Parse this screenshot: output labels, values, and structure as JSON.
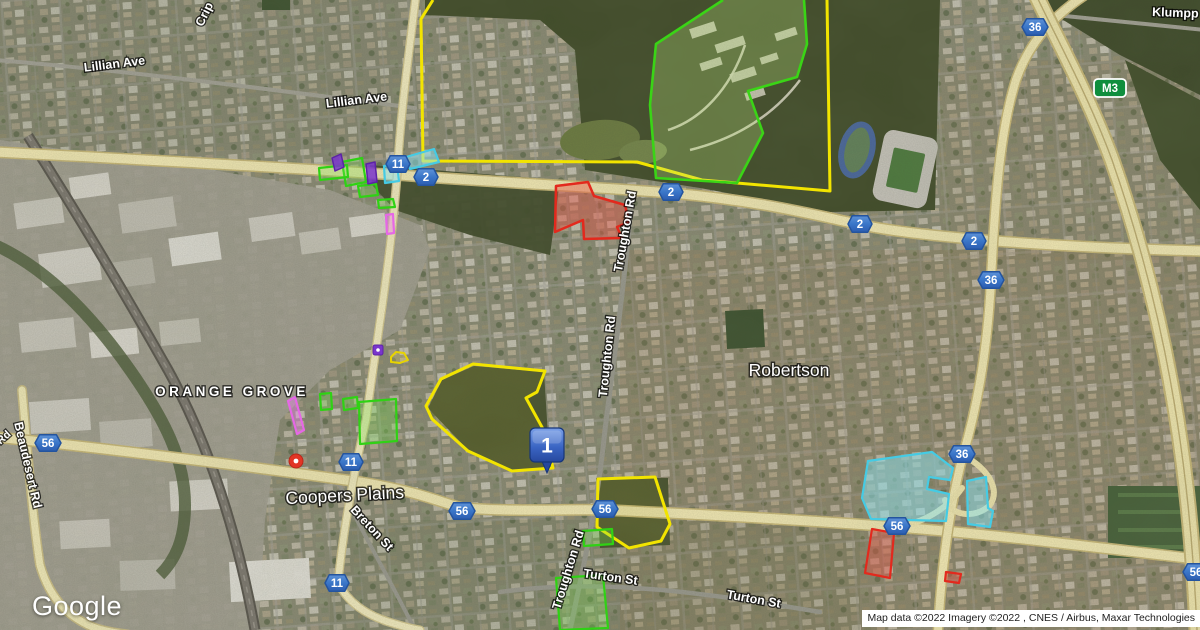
{
  "map": {
    "provider_logo": "Google",
    "attribution": "Map data ©2022 Imagery ©2022 , CNES / Airbus, Maxar Technologies",
    "marker": {
      "label": "1"
    },
    "localities": [
      {
        "name": "ORANGE GROVE"
      },
      {
        "name": "Coopers Plains"
      },
      {
        "name": "Robertson"
      }
    ],
    "road_labels": [
      {
        "text": "Lillian Ave"
      },
      {
        "text": "Lillian Ave"
      },
      {
        "text": "Crip"
      },
      {
        "text": "Klumpp Rd"
      },
      {
        "text": "Troughton Rd"
      },
      {
        "text": "Troughton Rd"
      },
      {
        "text": "Troughton Rd"
      },
      {
        "text": "Beaudesert Rd"
      },
      {
        "text": "Rd"
      },
      {
        "text": "Breton St"
      },
      {
        "text": "Turton St"
      },
      {
        "text": "Turton St"
      }
    ],
    "route_shields": [
      {
        "route": "2"
      },
      {
        "route": "2"
      },
      {
        "route": "2"
      },
      {
        "route": "2"
      },
      {
        "route": "36"
      },
      {
        "route": "36"
      },
      {
        "route": "36"
      },
      {
        "route": "56"
      },
      {
        "route": "56"
      },
      {
        "route": "56"
      },
      {
        "route": "56"
      },
      {
        "route": "56"
      },
      {
        "route": "11"
      },
      {
        "route": "11"
      },
      {
        "route": "11"
      },
      {
        "route": "M3"
      }
    ],
    "overlay_colors": {
      "boundary_yellow": "#f2e400",
      "boundary_green": "#3ad416",
      "boundary_red": "#e3291d",
      "boundary_cyan": "#45cbe4",
      "boundary_magenta": "#e667e6",
      "boundary_purple": "#7a35cc",
      "shield_blue": "#3a76c8",
      "m3_green": "#0f8e3d"
    }
  }
}
